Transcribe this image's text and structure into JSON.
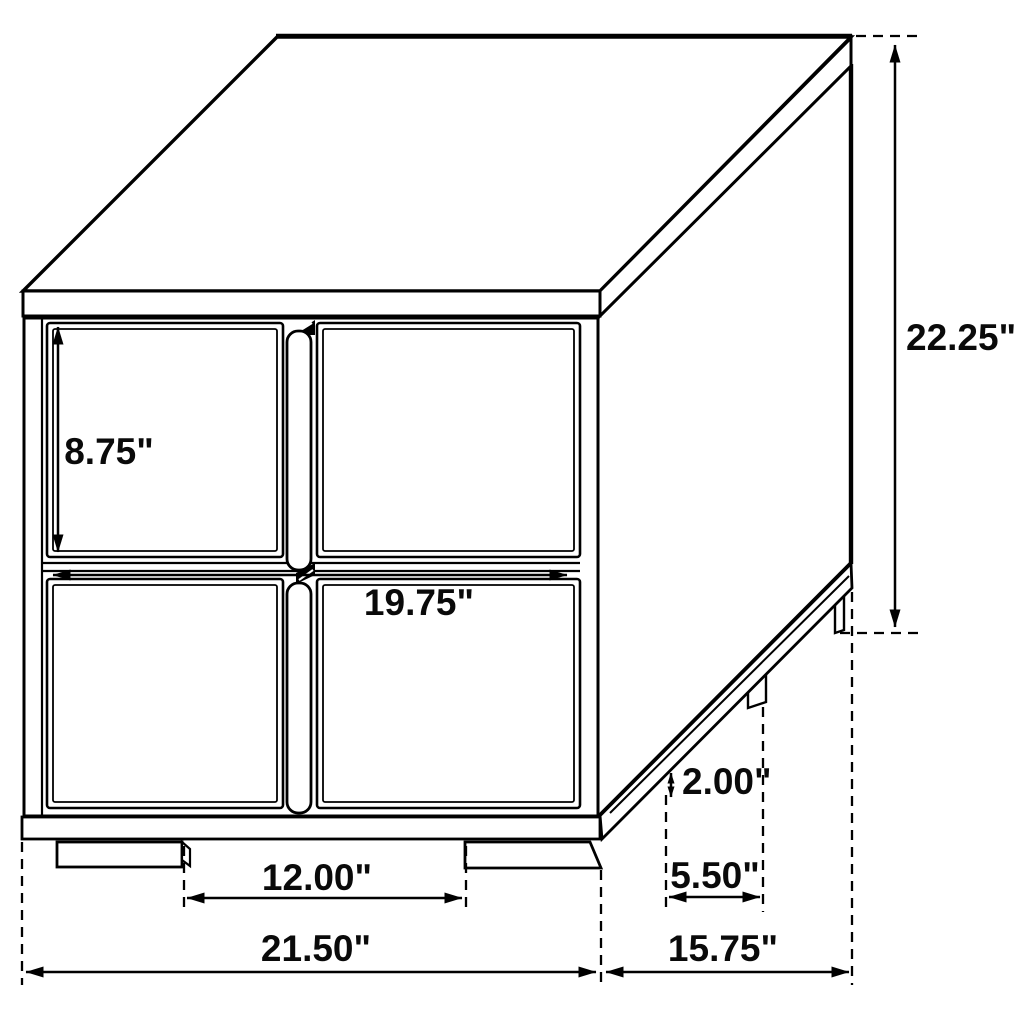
{
  "colors": {
    "background": "#ffffff",
    "line": "#000000",
    "text": "#0a0a0a"
  },
  "dimensions": {
    "drawer_front_height": "8.75\"",
    "drawer_front_width": "19.75\"",
    "overall_height": "22.25\"",
    "front_leg_spacing": "12.00\"",
    "overall_width": "21.50\"",
    "overall_depth": "15.75\"",
    "leg_height": "2.00\"",
    "side_leg_spacing": "5.50\""
  }
}
